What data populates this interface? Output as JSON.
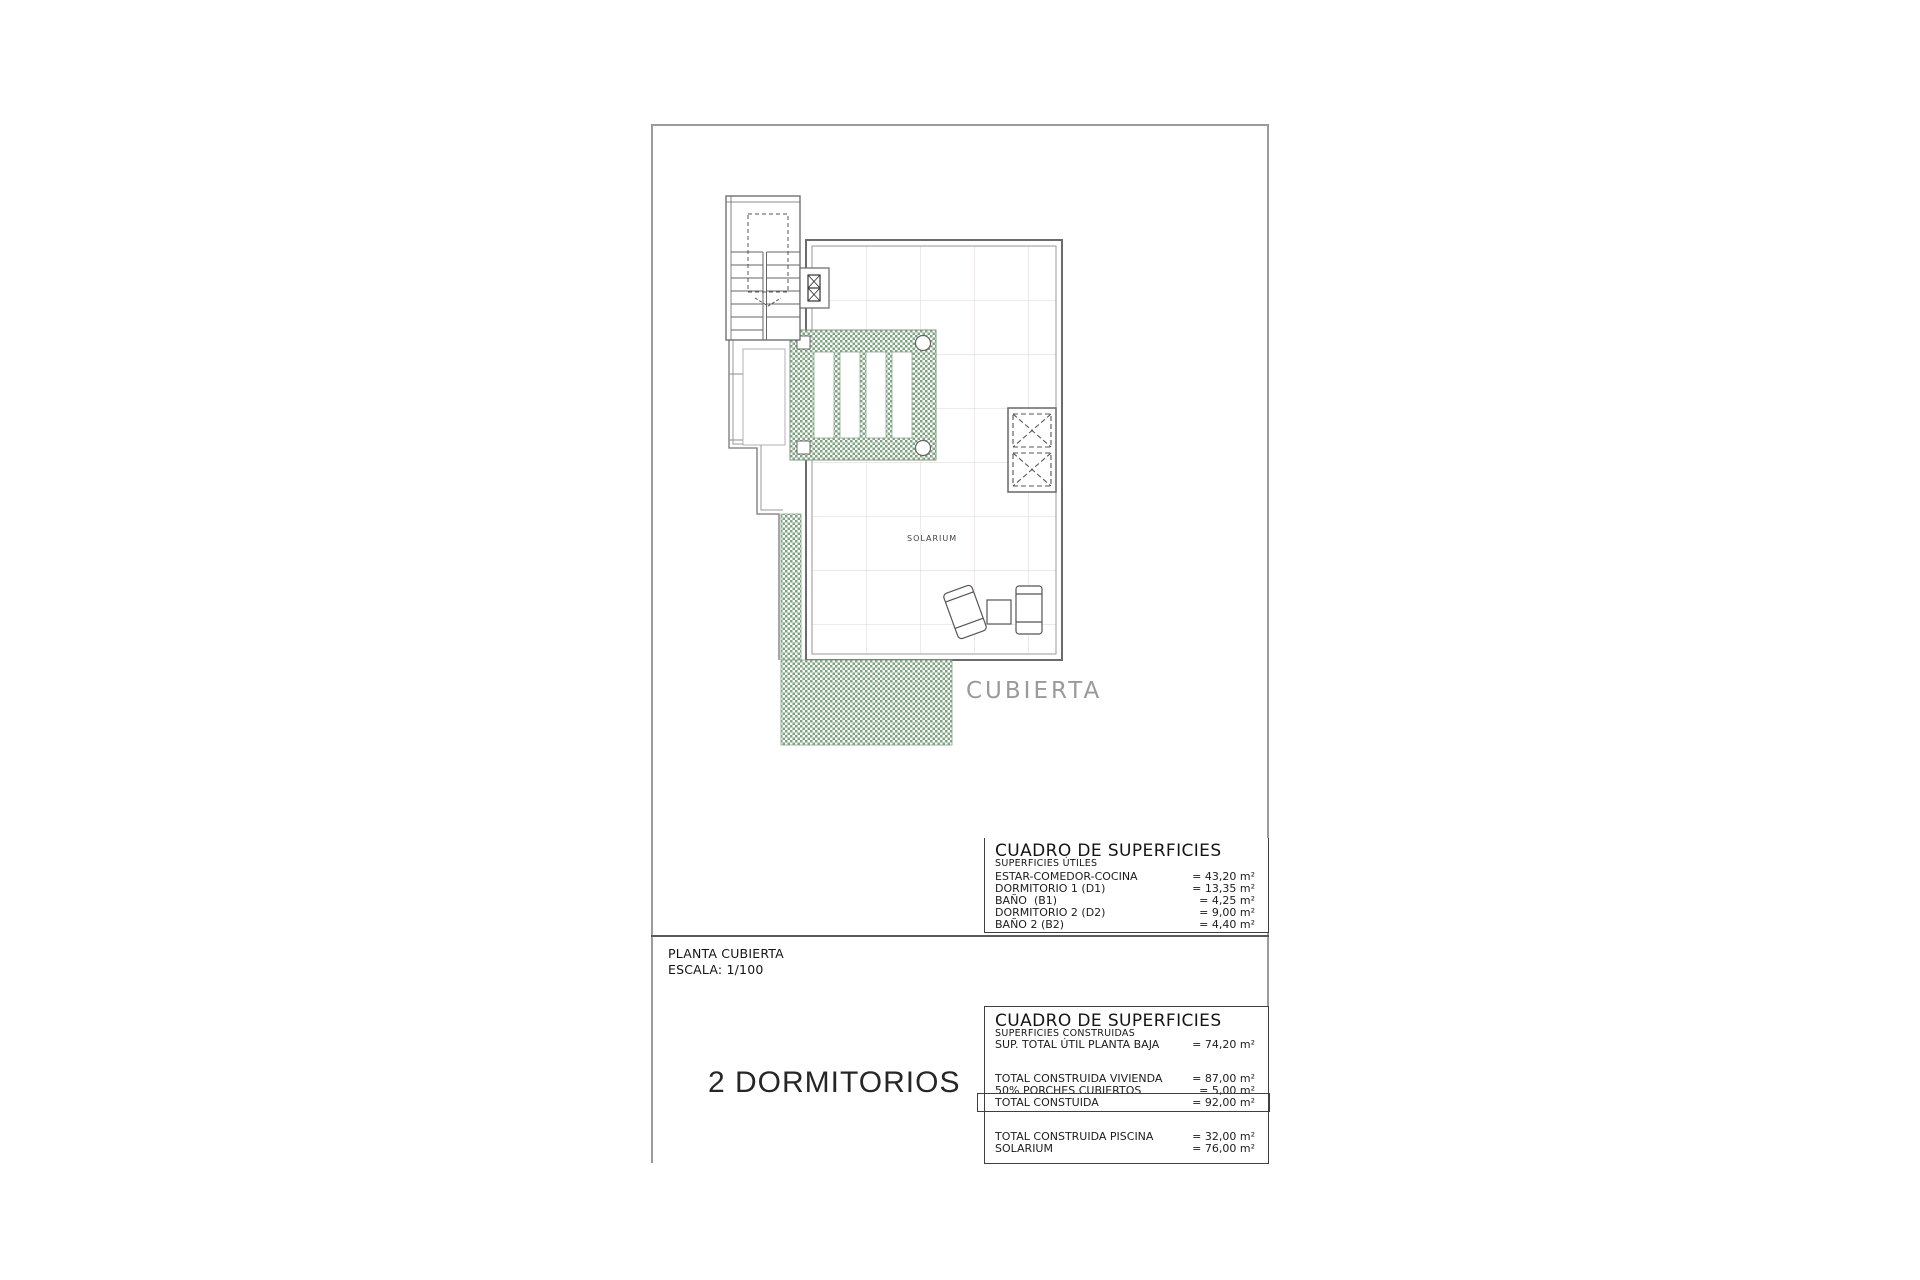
{
  "document": {
    "type_label": "PLANTA CUBIERTA",
    "scale_label": "ESCALA: 1/100",
    "variant_label": "2 DORMITORIOS"
  },
  "plan": {
    "area_label": "SOLARIUM",
    "roof_label": "CUBIERTA"
  },
  "surface_tables": {
    "utiles": {
      "title": "CUADRO DE SUPERFICIES",
      "subtitle": "SUPERFICIES ÚTILES",
      "rows": [
        {
          "label": "ESTAR-COMEDOR-COCINA",
          "value": "= 43,20 m²"
        },
        {
          "label": "DORMITORIO 1 (D1)",
          "value": "= 13,35 m²"
        },
        {
          "label": "BAÑO  (B1)",
          "value": "= 4,25 m²"
        },
        {
          "label": "DORMITORIO 2 (D2)",
          "value": "= 9,00 m²"
        },
        {
          "label": "BAÑO 2 (B2)",
          "value": "= 4,40 m²"
        }
      ]
    },
    "construidas": {
      "title": "CUADRO DE SUPERFICIES",
      "subtitle": "SUPERFICIES CONSTRUIDAS",
      "rows": [
        {
          "label": "SUP. TOTAL ÚTIL PLANTA BAJA",
          "value": "= 74,20 m²"
        },
        {
          "label": "TOTAL CONSTRUIDA VIVIENDA",
          "value": "= 87,00 m²"
        },
        {
          "label": "50% PORCHES CUBIERTOS",
          "value": "= 5,00 m²"
        },
        {
          "label": "TOTAL CONSTUIDA",
          "value": "= 92,00 m²"
        },
        {
          "label": "TOTAL CONSTRUIDA PISCINA",
          "value": "= 32,00 m²"
        },
        {
          "label": "SOLARIUM",
          "value": "= 76,00 m²"
        }
      ]
    }
  },
  "colors": {
    "hatch_green": "#7da381",
    "tile_grid": "#e3dae0",
    "frame_gray": "#9b9b9b",
    "line_dark": "#555555",
    "roof_label_gray": "#9a9a9a",
    "text": "#1c1c1c"
  }
}
